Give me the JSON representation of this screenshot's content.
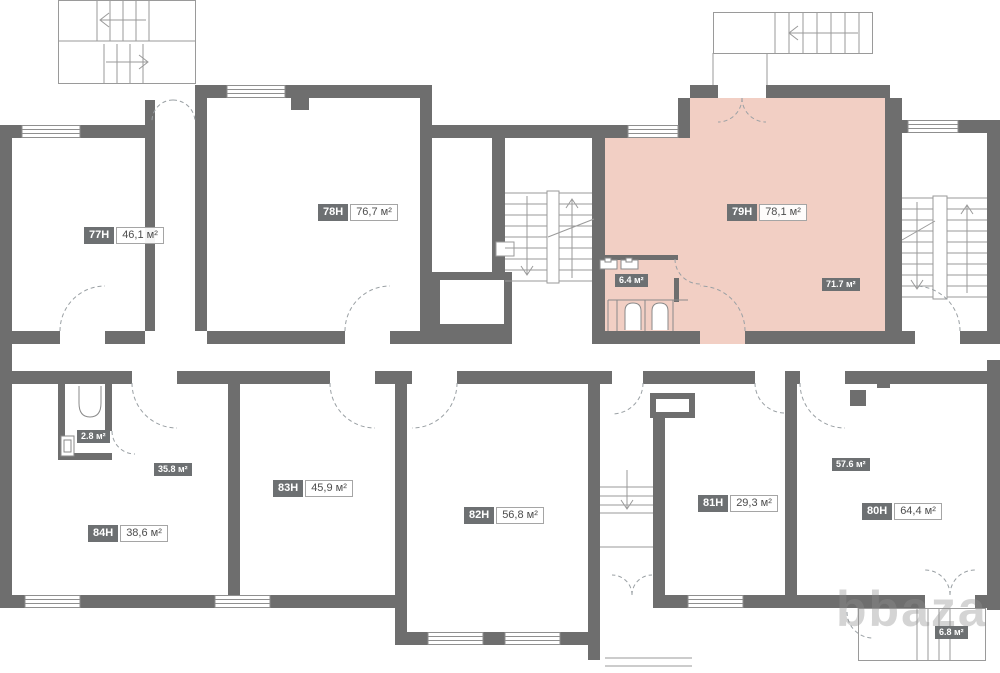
{
  "plan": {
    "highlight_color": "#f2cfc4",
    "wall_color": "#6e6e6e",
    "badge_color": "#6d7072"
  },
  "units": [
    {
      "id": "77H",
      "area": "46,1 м²"
    },
    {
      "id": "78H",
      "area": "76,7 м²"
    },
    {
      "id": "79H",
      "area": "78,1 м²",
      "highlighted": true
    },
    {
      "id": "80H",
      "area": "64,4 м²"
    },
    {
      "id": "81H",
      "area": "29,3 м²"
    },
    {
      "id": "82H",
      "area": "56,8 м²"
    },
    {
      "id": "83H",
      "area": "45,9 м²"
    },
    {
      "id": "84H",
      "area": "38,6 м²"
    }
  ],
  "sub_areas": [
    {
      "value": "6.4 м²"
    },
    {
      "value": "71.7 м²"
    },
    {
      "value": "2.8 м²"
    },
    {
      "value": "35.8 м²"
    },
    {
      "value": "57.6 м²"
    },
    {
      "value": "6.8 м²"
    }
  ],
  "watermark": "bbaza"
}
